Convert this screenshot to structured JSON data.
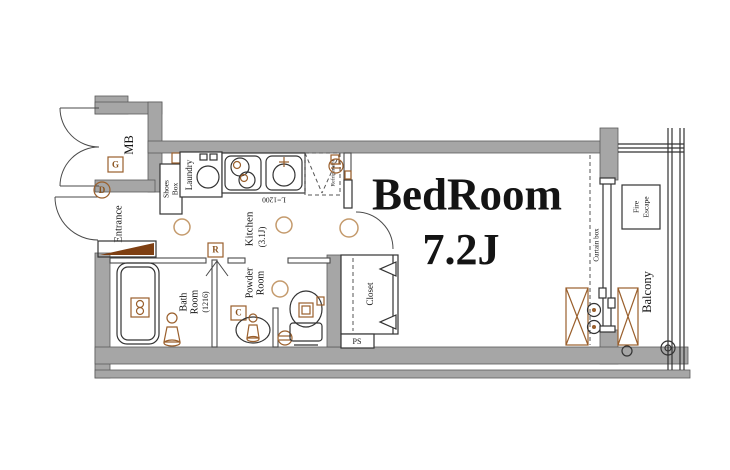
{
  "plan": {
    "bedroom": {
      "name": "BedRoom",
      "size": "7.2J"
    },
    "kitchen": {
      "name": "Kitchen",
      "size": "(3.1J)"
    },
    "bath": {
      "word1": "Bath",
      "word2": "Room",
      "size": "(1216)"
    },
    "powder": {
      "word1": "Powder",
      "word2": "Room"
    },
    "entrance": {
      "name": "Entrance"
    },
    "closet": {
      "name": "Closet"
    },
    "balcony": {
      "name": "Balcony"
    },
    "mb": {
      "name": "MB"
    },
    "laundry": {
      "name": "Laundry"
    },
    "shoes": {
      "word1": "Shoes",
      "word2": "Box"
    },
    "refrigerator": {
      "name": "Refrigerator"
    },
    "fire_escape": {
      "word1": "Fire",
      "word2": "Escape"
    },
    "curtain_box": {
      "name": "Curtain box"
    },
    "ps": {
      "name": "PS"
    },
    "counter_length": "L=1200",
    "markers": {
      "g": "G",
      "d": "D",
      "r": "R",
      "c": "C"
    }
  },
  "colors": {
    "wall": "#a6a6a6",
    "line": "#333333",
    "accent_brown": "#9a5f2c",
    "accent_tan": "#c49a6c",
    "step_brown": "#7e3f12",
    "text": "#141414"
  }
}
